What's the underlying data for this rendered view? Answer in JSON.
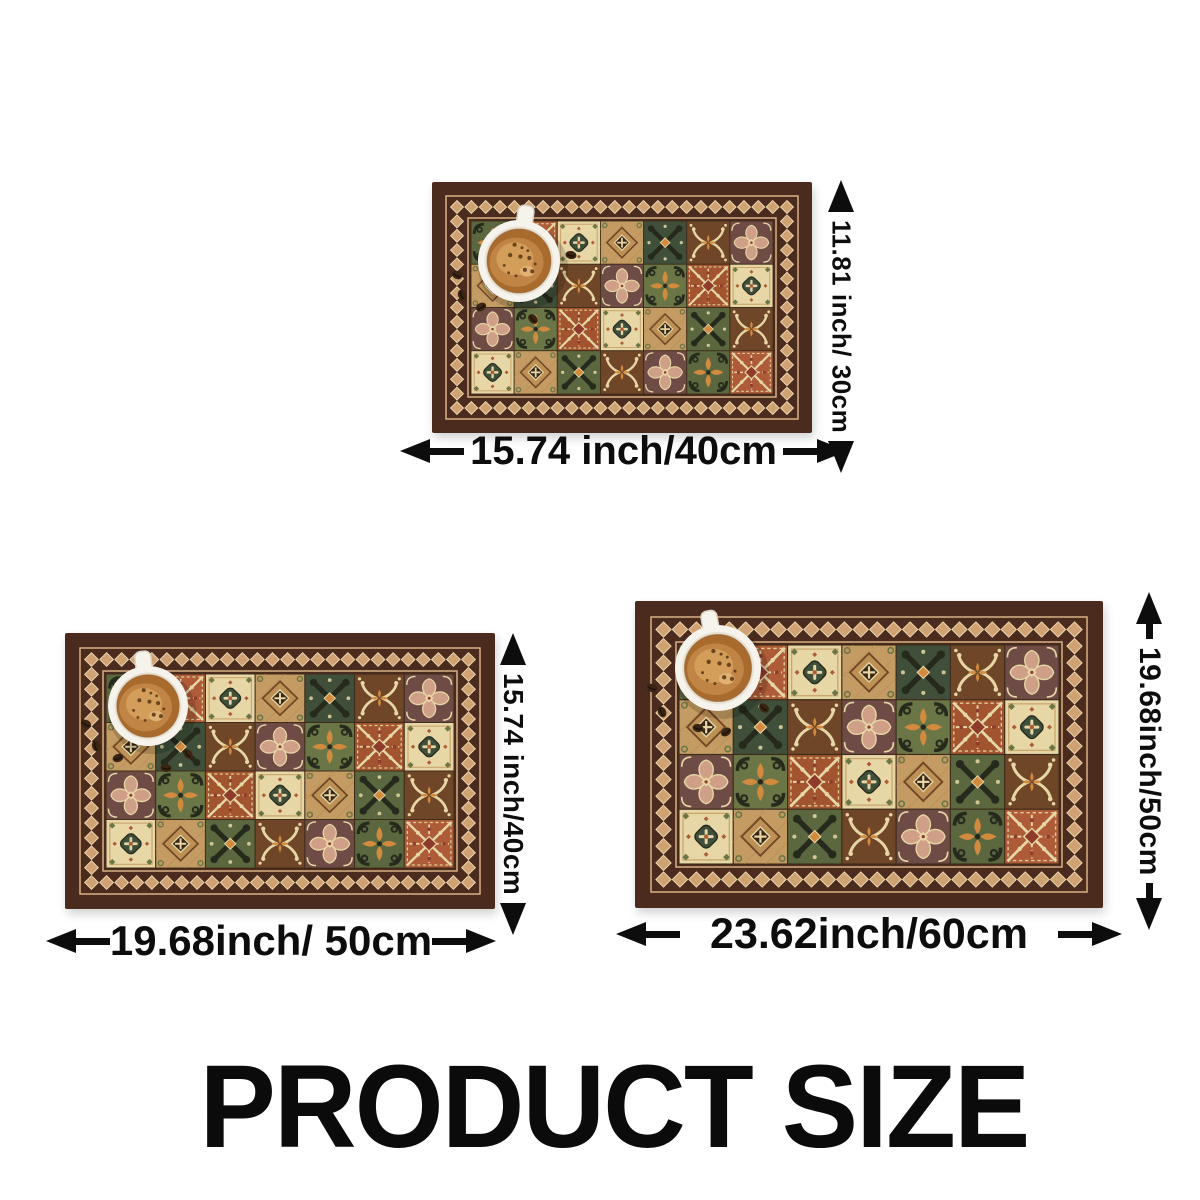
{
  "title": {
    "text": "PRODUCT SIZE"
  },
  "mats": [
    {
      "name": "placemat-40x30",
      "width_label": "15.74 inch/40cm",
      "height_label": "11.81 inch/ 30cm"
    },
    {
      "name": "placemat-50x40",
      "width_label": "19.68inch/ 50cm",
      "height_label": "15.74 inch/40cm"
    },
    {
      "name": "placemat-60x50",
      "width_label": "23.62inch/60cm",
      "height_label": "19.68inch/50cm"
    }
  ],
  "icons": {
    "coffee_cup": "coffee-cup-icon",
    "coffee_bean": "coffee-bean-icon",
    "dimension_arrow": "double-arrow-icon"
  },
  "colors": {
    "frame": "#4a2b1d",
    "stripe": "#d9b183",
    "diamond": "#cfa173",
    "diamondEdge": "#ecd6ad",
    "grid": "#3e2c1a",
    "olive": "#6b7647",
    "oliveDark": "#5a673f",
    "darkGreen": "#3f4f3a",
    "ink": "#262a1c",
    "orange": "#d28a3e",
    "rust": "#ae5c38",
    "cream": "#e7d7a6",
    "tan": "#c49c63",
    "tanDark": "#bd9156",
    "brown": "#6f4627",
    "plum": "#6f4b45",
    "pink": "#cf9f87",
    "redAccent": "#8e3b2c",
    "cupWhite": "#f6f3ec",
    "cupInner": "#e8e2d4",
    "coffee": "#a96b2d",
    "crema": "#c08445",
    "foam": "#d4a15c",
    "speck": "#5e3a17",
    "bean": "#3a2412"
  }
}
